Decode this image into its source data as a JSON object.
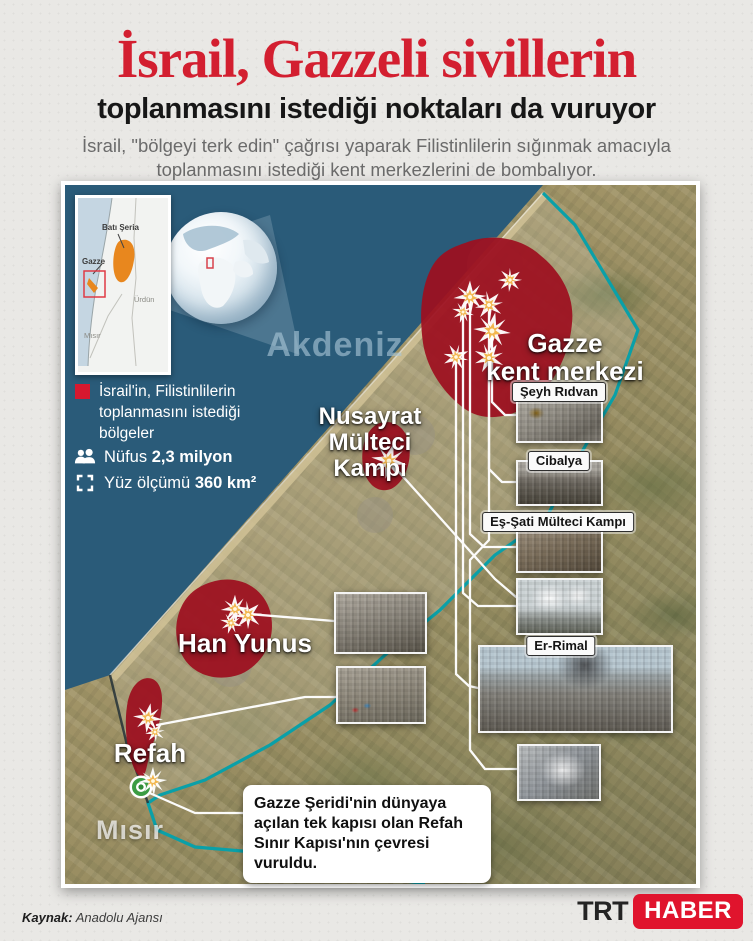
{
  "header": {
    "title": "İsrail, Gazzeli sivillerin",
    "subtitle": "toplanmasını istediği noktaları da vuruyor",
    "description": "İsrail, \"bölgeyi terk edin\" çağrısı yaparak Filistinlilerin sığınmak amacıyla toplanmasını istediği kent merkezlerini de bombalıyor."
  },
  "inset_map": {
    "west_bank": "Batı Şeria",
    "gaza": "Gazze",
    "jordan": "Ürdün",
    "egypt": "Mısır"
  },
  "legend": {
    "marker_note": "İsrail'in, Filistinlilerin toplanmasını istediği bölgeler",
    "population_label": "Nüfus",
    "population_value": "2,3 milyon",
    "area_label": "Yüz ölçümü",
    "area_value": "360 km²"
  },
  "map_labels": {
    "sea": "Akdeniz",
    "gaza_city_1": "Gazze",
    "gaza_city_2": "kent merkezi",
    "nusayrat_1": "Nusayrat",
    "nusayrat_2": "Mülteci Kampı",
    "khan_yunis": "Han Yunus",
    "rafah": "Refah",
    "egypt": "Mısır"
  },
  "photo_labels": {
    "seyh_ridvan": "Şeyh Rıdvan",
    "cibalya": "Cibalya",
    "es_sati": "Eş-Şati Mülteci Kampı",
    "er_rimal": "Er-Rimal"
  },
  "callout": "Gazze Şeridi'nin dünyaya açılan tek kapısı olan Refah Sınır Kapısı'nın çevresi vuruldu.",
  "footer": {
    "source_label": "Kaynak:",
    "source_name": "Anadolu Ajansı",
    "logo_trt": "TRT",
    "logo_haber": "HABER"
  },
  "colors": {
    "accent_red": "#d31f30",
    "strike_zone_red": "#9d0f1f",
    "sea_blue": "#2a5b79",
    "border_teal": "#0aa0a8",
    "logo_red": "#e0142d"
  }
}
